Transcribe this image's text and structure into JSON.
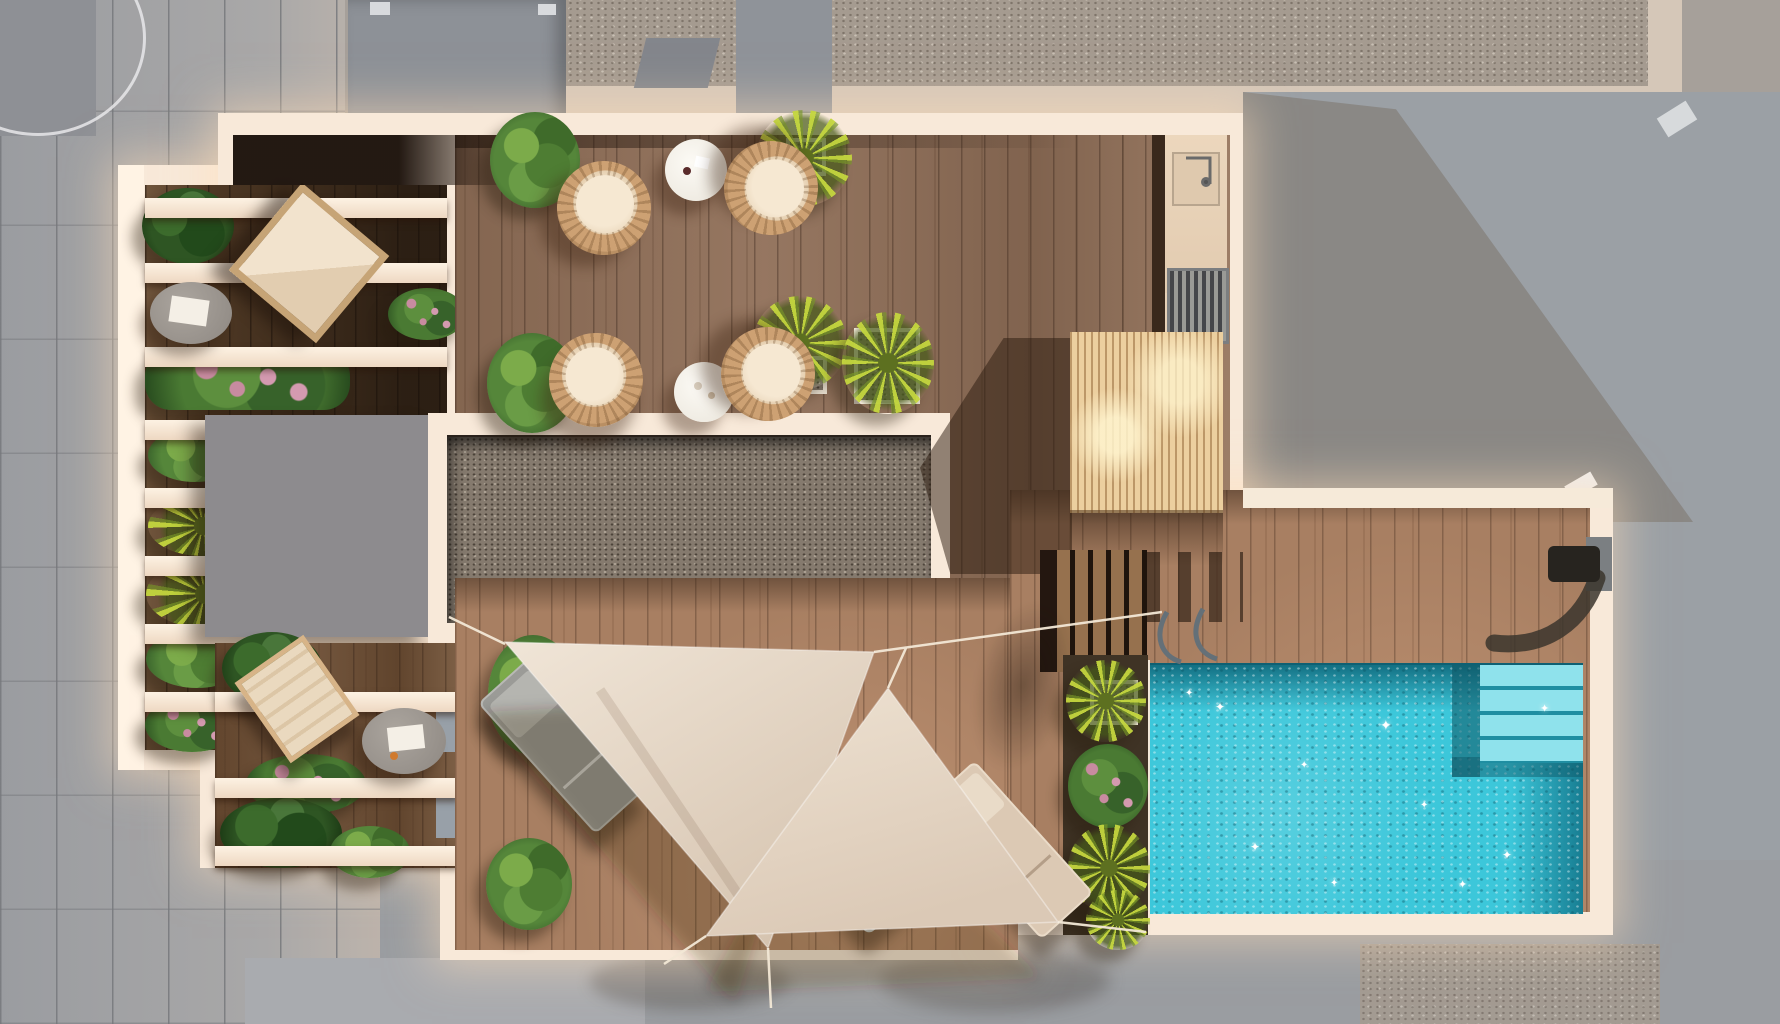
{
  "scene": {
    "title": "Rooftop terrace with swimming pool – aerial 3D architectural render",
    "view": "top-down",
    "canvas": {
      "width": 1780,
      "height": 1024
    },
    "no_visible_text": true
  },
  "palette": {
    "street_gray": "#a2a4a8",
    "neighbor_roof_gray": "#a6a09a",
    "roof_gravel": "#a59b90",
    "terrace_cream": "#f8e9d9",
    "deck_wood": "#8f6e57",
    "deck_wood_dark": "#4e3824",
    "deck_wood_sunlit": "#a87f62",
    "skylight_gravel": "#857a6e",
    "elevator_block_gray": "#8d8b8e",
    "pergola_wood": "#eccf9f",
    "pool_water": "#3cc7da",
    "pool_water_deep": "#177d92",
    "sail_fabric": "#e9dccb",
    "foliage_green": "#55863a",
    "foliage_palm_yellow": "#bcd23c",
    "flower_pink": "#c88ba0",
    "lounger_gray": "#9b9b97",
    "lounger_cream": "#dcc9b4"
  },
  "elements": {
    "left_balcony_rows": 8,
    "lower_left_joists": 3,
    "wicker_chairs": 4,
    "round_white_tables": 2,
    "round_gray_side_tables": 2,
    "sun_loungers": {
      "gray": 2,
      "cream": 1
    },
    "shade_sails": 2,
    "bushes_and_palms": 20,
    "skylight_gravel_bed": 1,
    "elevator_bulkhead_block": 1,
    "slatted_pergola_canopy": 1,
    "outdoor_sink_counter": 1,
    "floor_grille": 1,
    "deck_stairs_steps": 5,
    "pool": {
      "corner_steps": 4,
      "ladder": true,
      "wall_water_feature": true,
      "sparkles": 10
    }
  }
}
